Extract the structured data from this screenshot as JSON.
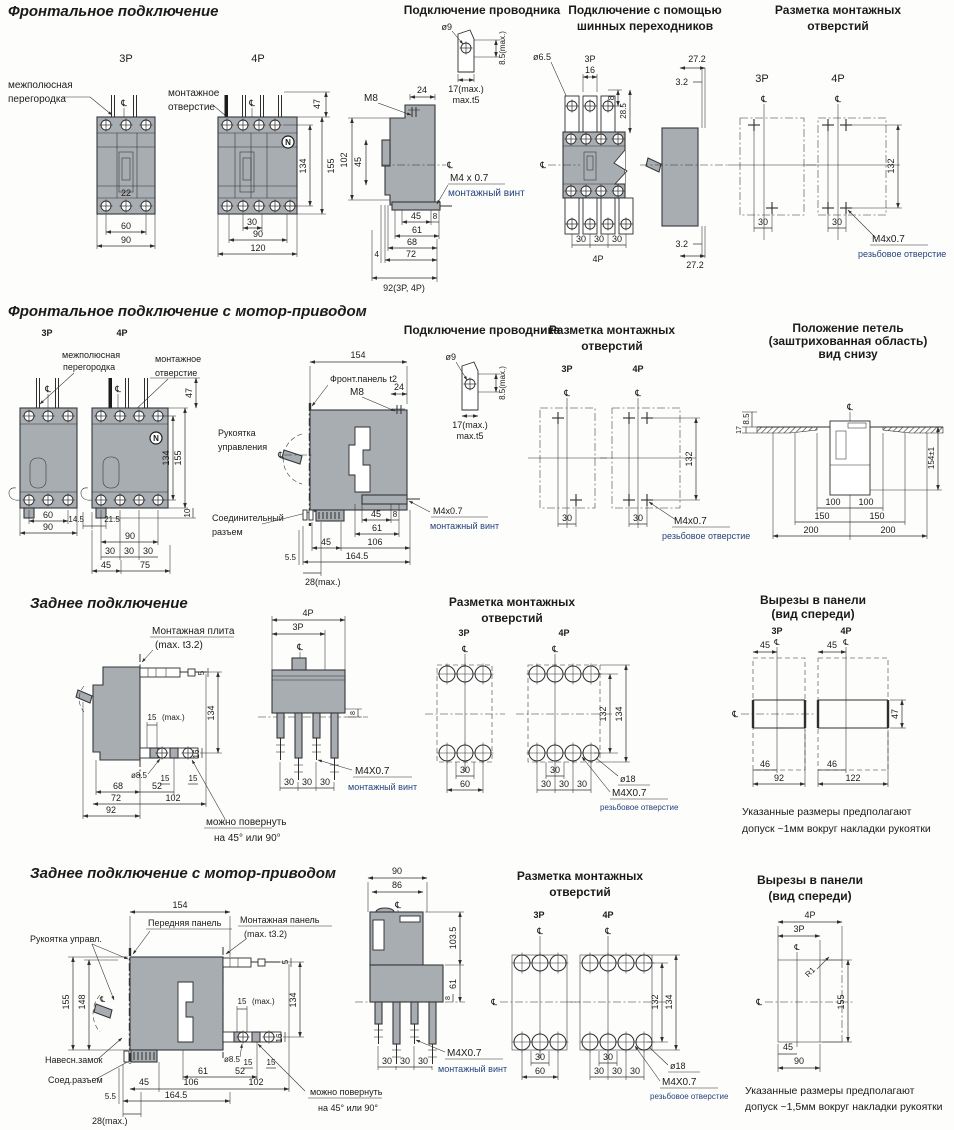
{
  "cl": "℄",
  "s1": {
    "title": "Фронтальное подключение",
    "front": {
      "p3": "3P",
      "p4": "4P",
      "barrier1": "межполюсная",
      "barrier2": "перегородка",
      "hole1": "монтажное",
      "hole2": "отверстие",
      "n": "N",
      "d22": "22",
      "d60": "60",
      "d90": "90",
      "d30": "30",
      "d90b": "90",
      "d120": "120",
      "d47": "47",
      "d134": "134",
      "d155": "155"
    },
    "cond": {
      "title": "Подключение проводника",
      "dia9": "ø9",
      "d85max": "8.5(max.)",
      "d17max": "17(max.)",
      "t5": "max.t5",
      "m8": "M8",
      "d24": "24",
      "d102": "102",
      "d45v": "45",
      "m4": "M4 x 0.7",
      "m4sub": "монтажный винт",
      "d45": "45",
      "d8": "8",
      "d61": "61",
      "d68": "68",
      "d72": "72",
      "d4": "4",
      "d92": "92(3P, 4P)"
    },
    "bus": {
      "title1": "Подключение с помощью",
      "title2": "шинных переходников",
      "dia65": "ø6.5",
      "p3": "3P",
      "d16": "16",
      "d8": "8",
      "d285": "28.5",
      "d30a": "30",
      "d30b": "30",
      "d30c": "30",
      "p4": "4P",
      "d272t": "27.2",
      "d32t": "3.2",
      "d32b": "3.2",
      "d272b": "27.2"
    },
    "holes": {
      "title1": "Разметка монтажных",
      "title2": "отверстий",
      "p3": "3P",
      "p4": "4P",
      "d30a": "30",
      "d30b": "30",
      "d132": "132",
      "m4": "M4x0.7",
      "m4sub": "резьбовое отверстие"
    }
  },
  "s2": {
    "title": "Фронтальное подключение с мотор-приводом",
    "front": {
      "p3": "3P",
      "p4": "4P",
      "barrier1": "межполюсная",
      "barrier2": "перегородка",
      "hole1": "монтажное",
      "hole2": "отверстие",
      "n": "N",
      "d60": "60",
      "d90": "90",
      "d145": "14.5",
      "d215": "21.5",
      "d90b": "90",
      "d30a": "30",
      "d30b": "30",
      "d30c": "30",
      "d45": "45",
      "d75": "75",
      "d47": "47",
      "d134": "134",
      "d155": "155",
      "d10": "10"
    },
    "side": {
      "d154": "154",
      "fpanel": "Фронт.панель t2",
      "m8": "M8",
      "d24": "24",
      "handle1": "Рукоятка",
      "handle2": "управления",
      "conn1": "Соединительный",
      "conn2": "разъем",
      "m4": "M4x0.7",
      "m4sub": "монтажный винт",
      "d45a": "45",
      "d8": "8",
      "d61": "61",
      "d45b": "45",
      "d106": "106",
      "d1645": "164.5",
      "d55": "5.5",
      "d28": "28(max.)"
    },
    "cond": {
      "title": "Подключение проводника",
      "dia9": "ø9",
      "d85max": "8.5(max.)",
      "d17max": "17(max.)",
      "t5": "max.t5"
    },
    "holes": {
      "title1": "Разметка монтажных",
      "title2": "отверстий",
      "p3": "3P",
      "p4": "4P",
      "d30a": "30",
      "d30b": "30",
      "d132": "132",
      "m4": "M4x0.7",
      "m4sub": "резьбовое отверстие"
    },
    "hinge": {
      "title1": "Положение петель",
      "title2": "(заштрихованная область)",
      "title3": "вид снизу",
      "d85": "8.5",
      "d17": "17",
      "d154": "154±1",
      "d100a": "100",
      "d100b": "100",
      "d150a": "150",
      "d150b": "150",
      "d200a": "200",
      "d200b": "200"
    }
  },
  "s3": {
    "title": "Заднее подключение",
    "side": {
      "plate1": "Монтажная плита",
      "plate2": "(max. t3.2)",
      "d5": "5",
      "d134": "134",
      "d15": "15",
      "dmax": "(max.)",
      "dia85": "ø8.5",
      "d15a": "15",
      "d15b": "15",
      "d16": "16",
      "d68": "68",
      "d52": "52",
      "d72": "72",
      "d102": "102",
      "d92": "92",
      "rot1": "можно повернуть",
      "rot2": "на 45° или 90°"
    },
    "front": {
      "p4": "4P",
      "p3": "3P",
      "d8": "8",
      "d30a": "30",
      "d30b": "30",
      "d30c": "30",
      "m4": "M4X0.7",
      "m4sub": "монтажный винт"
    },
    "holes": {
      "title1": "Разметка монтажных",
      "title2": "отверстий",
      "p3": "3P",
      "p4": "4P",
      "d30_3": "30",
      "d60": "60",
      "d30_4": "30",
      "d30a": "30",
      "d30b": "30",
      "d30c": "30",
      "d132": "132",
      "d134": "134",
      "dia18": "ø18",
      "m4": "M4X0.7",
      "m4sub": "резьбовое отверстие"
    },
    "cut": {
      "title1": "Вырезы в панели",
      "title2": "(вид спереди)",
      "p3": "3P",
      "p4": "4P",
      "d45a": "45",
      "d45b": "45",
      "d47": "47",
      "d46a": "46",
      "d46b": "46",
      "d92": "92",
      "d122": "122",
      "note1": "Указанные размеры предполагают",
      "note2": "допуск ~1мм вокруг накладки рукоятки"
    }
  },
  "s4": {
    "title": "Заднее подключение с мотор-приводом",
    "side": {
      "handle": "Рукоятка управл.",
      "fpanel": "Передняя панель",
      "mpanel1": "Монтажная панель",
      "mpanel2": "(max. t3.2)",
      "lock": "Навесн.замок",
      "conn": "Соед.разъем",
      "d154": "154",
      "d148": "148",
      "d155": "155",
      "d5": "5",
      "d134": "134",
      "d15": "15",
      "dmax": "(max.)",
      "dia85": "ø8.5",
      "d15a": "15",
      "d15b": "15",
      "d16": "16",
      "d61": "61",
      "d52": "52",
      "d45": "45",
      "d106": "106",
      "d102": "102",
      "d1645": "164.5",
      "d55": "5.5",
      "d28": "28(max.)",
      "rot1": "можно повернуть",
      "rot2": "на 45° или 90°"
    },
    "front": {
      "d90": "90",
      "d86": "86",
      "d1035": "103.5",
      "d61": "61",
      "d8": "8",
      "d30a": "30",
      "d30b": "30",
      "d30c": "30",
      "m4": "M4X0.7",
      "m4sub": "монтажный винт"
    },
    "holes": {
      "title1": "Разметка монтажных",
      "title2": "отверстий",
      "p3": "3P",
      "p4": "4P",
      "d30_3": "30",
      "d60": "60",
      "d30_4": "30",
      "d30a": "30",
      "d30b": "30",
      "d30c": "30",
      "d132": "132",
      "d134": "134",
      "dia18": "ø18",
      "m4": "M4X0.7",
      "m4sub": "резьбовое отверстие"
    },
    "cut": {
      "title1": "Вырезы в панели",
      "title2": "(вид спереди)",
      "p4": "4P",
      "p3": "3P",
      "r1": "R1",
      "d155": "155",
      "d45": "45",
      "d90": "90",
      "note1": "Указанные размеры предполагают",
      "note2": "допуск ~1,5мм вокруг накладки рукоятки"
    }
  }
}
